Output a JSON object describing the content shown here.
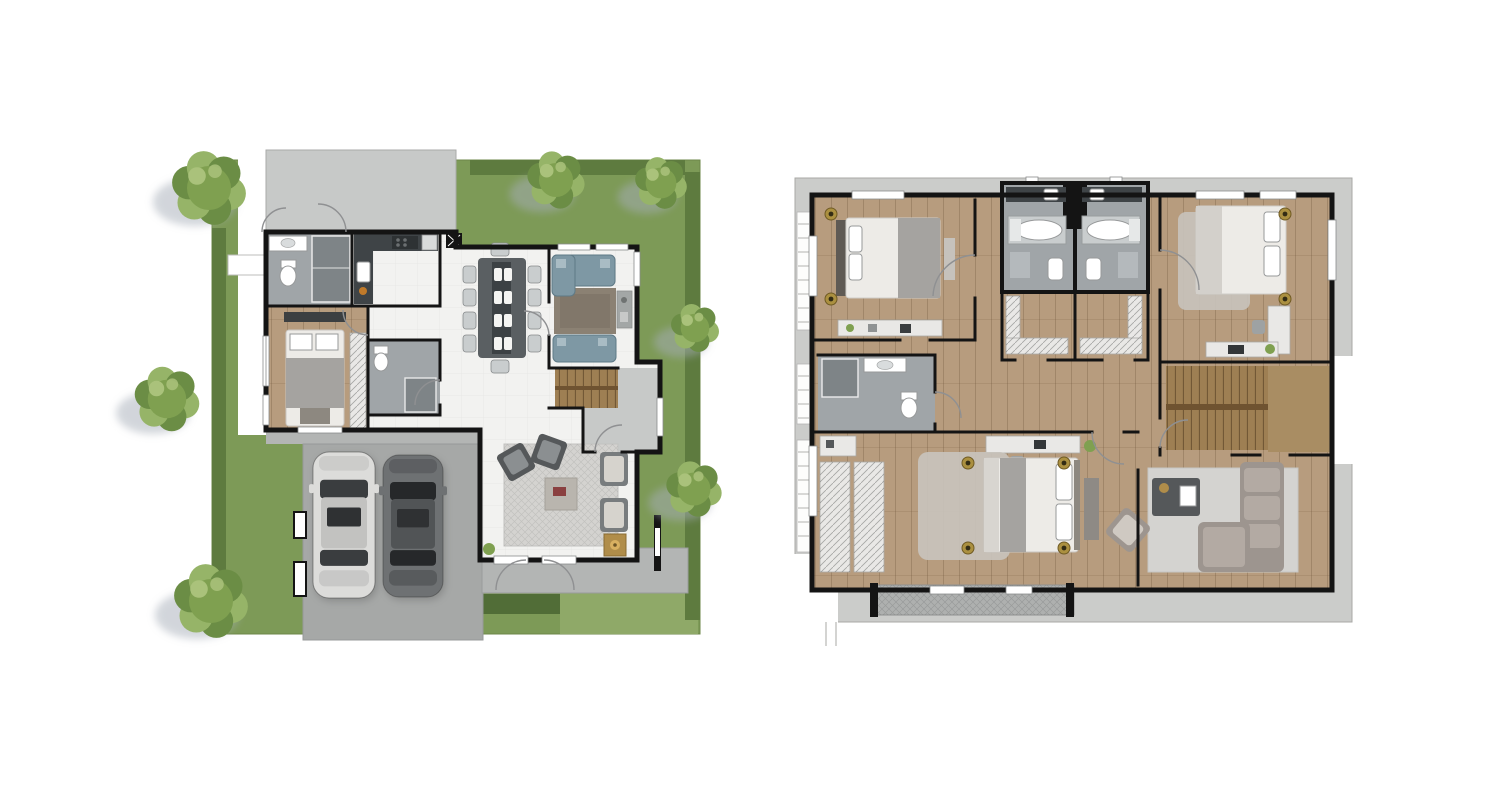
{
  "figure": {
    "type": "floor-plan-pair",
    "left_plan": "first-floor",
    "right_plan": "second-floor"
  },
  "palette": {
    "background": "#ffffff",
    "grass": "#7d9a57",
    "grass_light": "#8fa968",
    "hedge": "#5e7b3f",
    "hedge_dark": "#516d37",
    "tree_main": "#7fa050",
    "tree_light": "#96b468",
    "tree_dark": "#6b8d45",
    "shadow": "#a6adb8",
    "paving_light": "#c7c9c8",
    "paving_mid": "#b3b5b4",
    "paving_dark": "#a6a8a7",
    "wall": "#141414",
    "floor_white": "#f2f2f0",
    "wood": "#b79c7e",
    "wood_light": "#a98d63",
    "tile_gray": "#a0a5a8",
    "tile_dark": "#7e8487",
    "counter_dark": "#3f4447",
    "table_dark": "#5a5f62",
    "chair_light": "#c9cdce",
    "sofa_blue": "#7e98a4",
    "rug_brown": "#8b8173",
    "rug_light": "#d4d3d0",
    "rug_shag": "#c8c3bc",
    "furniture_gray": "#9d958f",
    "furniture_dark": "#55585a",
    "bed_white": "#edebe7",
    "bed_gray": "#a5a3a0",
    "headboard": "#5f5a54",
    "stairs_wood": "#9e7f53",
    "stairs_dark": "#6f5331",
    "wardrobe": "#e9e8e6",
    "gold": "#b08d4a",
    "eave": "#cbccca",
    "balcony": "#aeb0af"
  },
  "first_floor": {
    "trees": [
      {
        "cx": 209,
        "cy": 188,
        "r": 40
      },
      {
        "cx": 556,
        "cy": 180,
        "r": 31
      },
      {
        "cx": 661,
        "cy": 183,
        "r": 28
      },
      {
        "cx": 695,
        "cy": 328,
        "r": 26
      },
      {
        "cx": 694,
        "cy": 489,
        "r": 30
      },
      {
        "cx": 167,
        "cy": 399,
        "r": 35
      },
      {
        "cx": 211,
        "cy": 601,
        "r": 40
      }
    ],
    "cars": [
      {
        "kind": "light-car",
        "x": 313,
        "y": 452,
        "w": 62,
        "h": 146,
        "body": "#dcdcda",
        "roof": "#c2c2c0",
        "glass": "#3a3d3f"
      },
      {
        "kind": "dark-car",
        "x": 383,
        "y": 455,
        "w": 60,
        "h": 142,
        "body": "#6e7173",
        "roof": "#515456",
        "glass": "#26282a"
      }
    ]
  },
  "second_floor": {
    "downlights": [
      {
        "cx": 831,
        "cy": 214
      },
      {
        "cx": 831,
        "cy": 299
      },
      {
        "cx": 1285,
        "cy": 214
      },
      {
        "cx": 1285,
        "cy": 299
      },
      {
        "cx": 968,
        "cy": 463
      },
      {
        "cx": 968,
        "cy": 548
      },
      {
        "cx": 1064,
        "cy": 463
      },
      {
        "cx": 1064,
        "cy": 548
      }
    ]
  }
}
